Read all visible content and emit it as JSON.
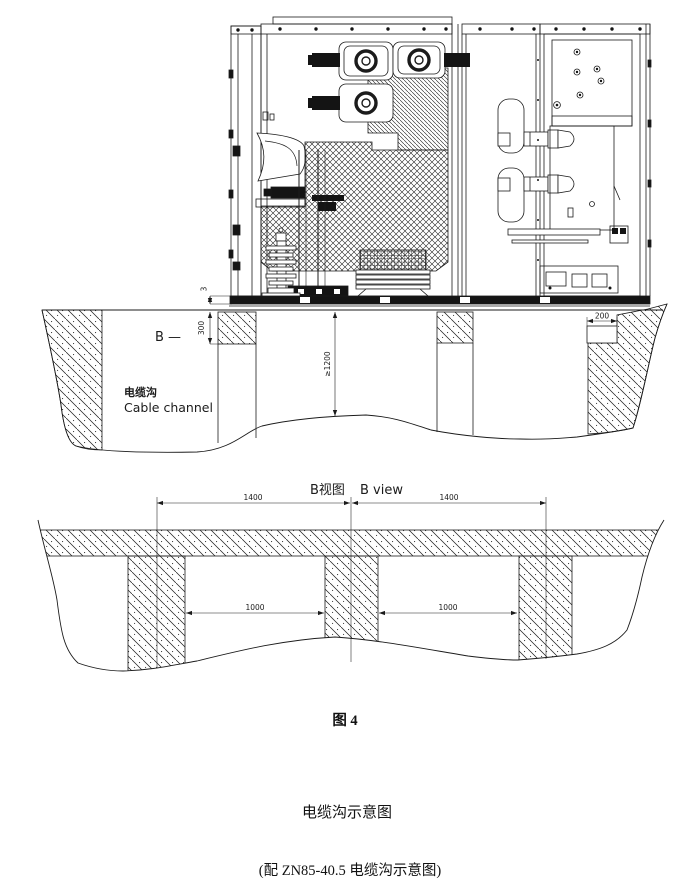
{
  "page": {
    "background": "#ffffff",
    "ink": "#1b1b1b"
  },
  "section_view": {
    "section_label": "B —",
    "cable_channel_cn": "电缆沟",
    "cable_channel_en": "Cable channel",
    "dims": {
      "base_gap": "3",
      "wall_depth": "300",
      "trench_depth": "≥1200",
      "ledge_width": "200"
    }
  },
  "b_view": {
    "title_cn": "B视图",
    "title_en": "B view",
    "dims": {
      "spacing_left": "1400",
      "spacing_right": "1400",
      "opening_left": "1000",
      "opening_right": "1000"
    }
  },
  "captions": {
    "figure_no": "图 4",
    "title": "电缆沟示意图",
    "note": "(配 ZN85-40.5 电缆沟示意图)"
  }
}
